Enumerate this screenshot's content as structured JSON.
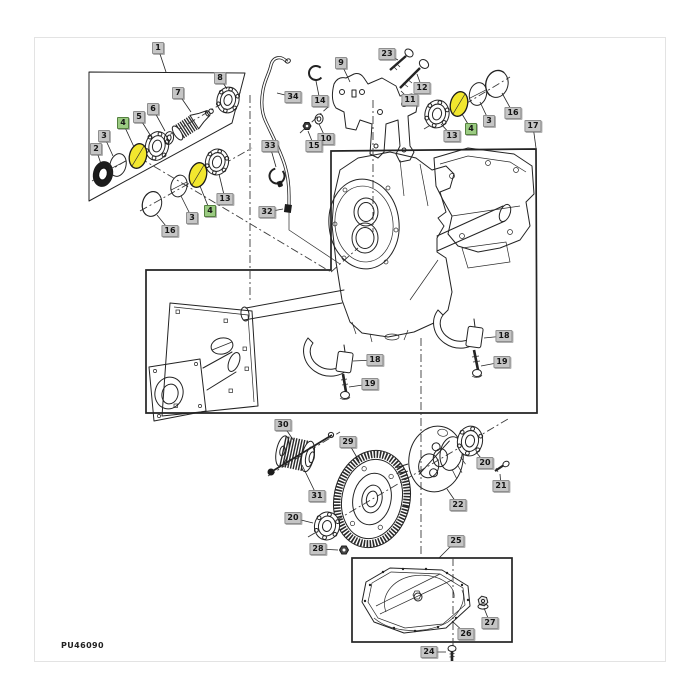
{
  "diagram": {
    "code": "PU46090",
    "type": "exploded-parts-diagram",
    "colors": {
      "highlight_part": "#f2e72e",
      "callout_bg": "#c5c5c5",
      "callout_border": "#8f8f8f",
      "callout_text": "#151515",
      "callout_highlight_bg": "#9bcb82",
      "callout_highlight_border": "#55813f",
      "line": "#232323"
    },
    "highlight_markers": [
      {
        "x": 138,
        "y": 156
      },
      {
        "x": 198,
        "y": 175
      },
      {
        "x": 459,
        "y": 104
      }
    ],
    "callouts": [
      {
        "label": "1",
        "x": 158,
        "y": 48,
        "lx": 166,
        "ly": 72,
        "highlighted": false
      },
      {
        "label": "8",
        "x": 220,
        "y": 78,
        "lx": 227,
        "ly": 89,
        "highlighted": false
      },
      {
        "label": "7",
        "x": 178,
        "y": 93,
        "lx": 191,
        "ly": 112,
        "highlighted": false
      },
      {
        "label": "6",
        "x": 153,
        "y": 109,
        "lx": 165,
        "ly": 131,
        "highlighted": false
      },
      {
        "label": "5",
        "x": 139,
        "y": 117,
        "lx": 152,
        "ly": 138,
        "highlighted": false
      },
      {
        "label": "4",
        "x": 123,
        "y": 123,
        "lx": 134,
        "ly": 147,
        "highlighted": true
      },
      {
        "label": "3",
        "x": 104,
        "y": 136,
        "lx": 113,
        "ly": 156,
        "highlighted": false
      },
      {
        "label": "2",
        "x": 96,
        "y": 149,
        "lx": 101,
        "ly": 164,
        "highlighted": false
      },
      {
        "label": "16",
        "x": 170,
        "y": 231,
        "lx": 157,
        "ly": 215,
        "highlighted": false
      },
      {
        "label": "3",
        "x": 192,
        "y": 218,
        "lx": 181,
        "ly": 196,
        "highlighted": false
      },
      {
        "label": "4",
        "x": 210,
        "y": 211,
        "lx": 200,
        "ly": 186,
        "highlighted": true
      },
      {
        "label": "13",
        "x": 225,
        "y": 199,
        "lx": 219,
        "ly": 174,
        "highlighted": false
      },
      {
        "label": "33",
        "x": 270,
        "y": 146,
        "lx": 276,
        "ly": 167,
        "highlighted": false
      },
      {
        "label": "32",
        "x": 267,
        "y": 212,
        "lx": 283,
        "ly": 209,
        "highlighted": false
      },
      {
        "label": "34",
        "x": 293,
        "y": 97,
        "lx": 277,
        "ly": 93,
        "highlighted": false
      },
      {
        "label": "14",
        "x": 320,
        "y": 101,
        "lx": 316,
        "ly": 81,
        "highlighted": false
      },
      {
        "label": "10",
        "x": 326,
        "y": 139,
        "lx": 319,
        "ly": 124,
        "highlighted": false
      },
      {
        "label": "15",
        "x": 314,
        "y": 146,
        "lx": 308,
        "ly": 131,
        "highlighted": false
      },
      {
        "label": "9",
        "x": 341,
        "y": 63,
        "lx": 350,
        "ly": 82,
        "highlighted": false
      },
      {
        "label": "23",
        "x": 387,
        "y": 54,
        "lx": 398,
        "ly": 60,
        "highlighted": false
      },
      {
        "label": "12",
        "x": 422,
        "y": 88,
        "lx": 417,
        "ly": 74,
        "highlighted": false
      },
      {
        "label": "11",
        "x": 410,
        "y": 100,
        "lx": 401,
        "ly": 91,
        "highlighted": false
      },
      {
        "label": "13",
        "x": 452,
        "y": 136,
        "lx": 441,
        "ly": 124,
        "highlighted": false
      },
      {
        "label": "4",
        "x": 471,
        "y": 129,
        "lx": 462,
        "ly": 114,
        "highlighted": true
      },
      {
        "label": "3",
        "x": 489,
        "y": 121,
        "lx": 480,
        "ly": 102,
        "highlighted": false
      },
      {
        "label": "16",
        "x": 513,
        "y": 113,
        "lx": 502,
        "ly": 93,
        "highlighted": false
      },
      {
        "label": "17",
        "x": 533,
        "y": 126,
        "lx": 536,
        "ly": 148,
        "highlighted": false
      },
      {
        "label": "18",
        "x": 375,
        "y": 360,
        "lx": 353,
        "ly": 361,
        "highlighted": false
      },
      {
        "label": "19",
        "x": 370,
        "y": 384,
        "lx": 349,
        "ly": 387,
        "highlighted": false
      },
      {
        "label": "18",
        "x": 504,
        "y": 336,
        "lx": 484,
        "ly": 338,
        "highlighted": false
      },
      {
        "label": "19",
        "x": 502,
        "y": 362,
        "lx": 481,
        "ly": 366,
        "highlighted": false
      },
      {
        "label": "30",
        "x": 283,
        "y": 425,
        "lx": 294,
        "ly": 441,
        "highlighted": false
      },
      {
        "label": "29",
        "x": 348,
        "y": 442,
        "lx": 359,
        "ly": 461,
        "highlighted": false
      },
      {
        "label": "31",
        "x": 317,
        "y": 496,
        "lx": 302,
        "ly": 465,
        "highlighted": false
      },
      {
        "label": "20",
        "x": 293,
        "y": 518,
        "lx": 313,
        "ly": 523,
        "highlighted": false
      },
      {
        "label": "28",
        "x": 318,
        "y": 549,
        "lx": 338,
        "ly": 550,
        "highlighted": false
      },
      {
        "label": "22",
        "x": 458,
        "y": 505,
        "lx": 447,
        "ly": 489,
        "highlighted": false
      },
      {
        "label": "20",
        "x": 485,
        "y": 463,
        "lx": 476,
        "ly": 452,
        "highlighted": false
      },
      {
        "label": "21",
        "x": 501,
        "y": 486,
        "lx": 500,
        "ly": 474,
        "highlighted": false
      },
      {
        "label": "25",
        "x": 456,
        "y": 541,
        "lx": 439,
        "ly": 558,
        "highlighted": false
      },
      {
        "label": "27",
        "x": 490,
        "y": 623,
        "lx": 484,
        "ly": 608,
        "highlighted": false
      },
      {
        "label": "26",
        "x": 466,
        "y": 634,
        "lx": 452,
        "ly": 621,
        "highlighted": false
      },
      {
        "label": "24",
        "x": 429,
        "y": 652,
        "lx": 446,
        "ly": 652,
        "highlighted": false
      }
    ]
  }
}
